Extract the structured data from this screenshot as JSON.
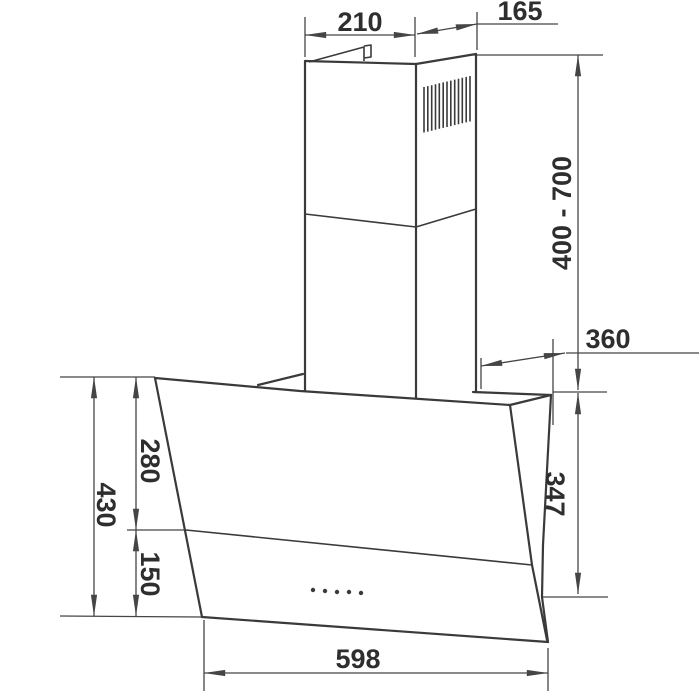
{
  "diagram": {
    "description": "Dimension drawing of a wall-mounted angled cooker hood with telescopic chimney",
    "dims": {
      "chimney_width": "210",
      "chimney_side_depth": "165",
      "chimney_height_range": "400 - 700",
      "hood_top_depth": "360",
      "front_total_height": "430",
      "front_upper_height": "280",
      "front_lower_height": "150",
      "rear_height": "347",
      "hood_width": "598"
    },
    "features": {
      "vent_slot_count": 13,
      "control_dot_count": 5
    },
    "colors": {
      "line": "#3a3a3a",
      "dimension_line": "#454545",
      "text": "#2e2e2e",
      "background": "#ffffff"
    }
  }
}
